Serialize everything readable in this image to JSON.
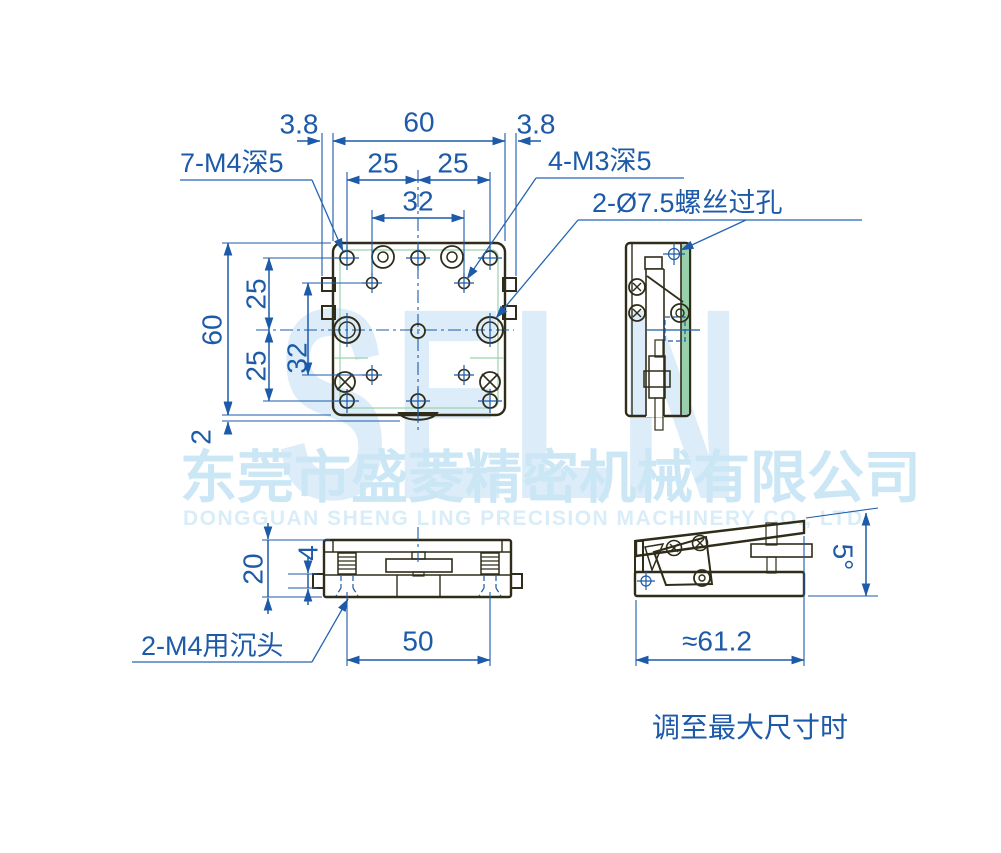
{
  "drawing": {
    "watermark": {
      "logo": "SELN",
      "company_cn": "东莞市盛菱精密机械有限公司",
      "company_en": "DONGGUAN SHENG LING PRECISION MACHINERY CO., LTD."
    },
    "top_view": {
      "dim_tab_left": "3.8",
      "dim_width": "60",
      "dim_tab_right": "3.8",
      "dim_pitch_left": "25",
      "dim_pitch_right": "25",
      "dim_pitch_32": "32",
      "dim_height": "60",
      "dim_v_pitch_upper": "25",
      "dim_v_pitch_lower": "25",
      "dim_v_pitch_32": "32",
      "dim_bump": "2",
      "label_m4": "7-M4深5",
      "label_m3": "4-M3深5",
      "label_through_hole": "2-Ø7.5螺丝过孔"
    },
    "front_view": {
      "dim_height": "20",
      "dim_tab_height": "4",
      "dim_hole_pitch": "50",
      "label_countersunk": "2-M4用沉头"
    },
    "tilt_view": {
      "dim_max_length": "≈61.2",
      "dim_max_angle": "5°",
      "caption": "调至最大尺寸时"
    },
    "colors": {
      "body_green": "#abdcbc",
      "body_green_dark": "#98d0ac",
      "outline": "#2f2d19",
      "dimension_blue": "#1d5aa8",
      "watermark_blue": "#dcedf9"
    }
  }
}
